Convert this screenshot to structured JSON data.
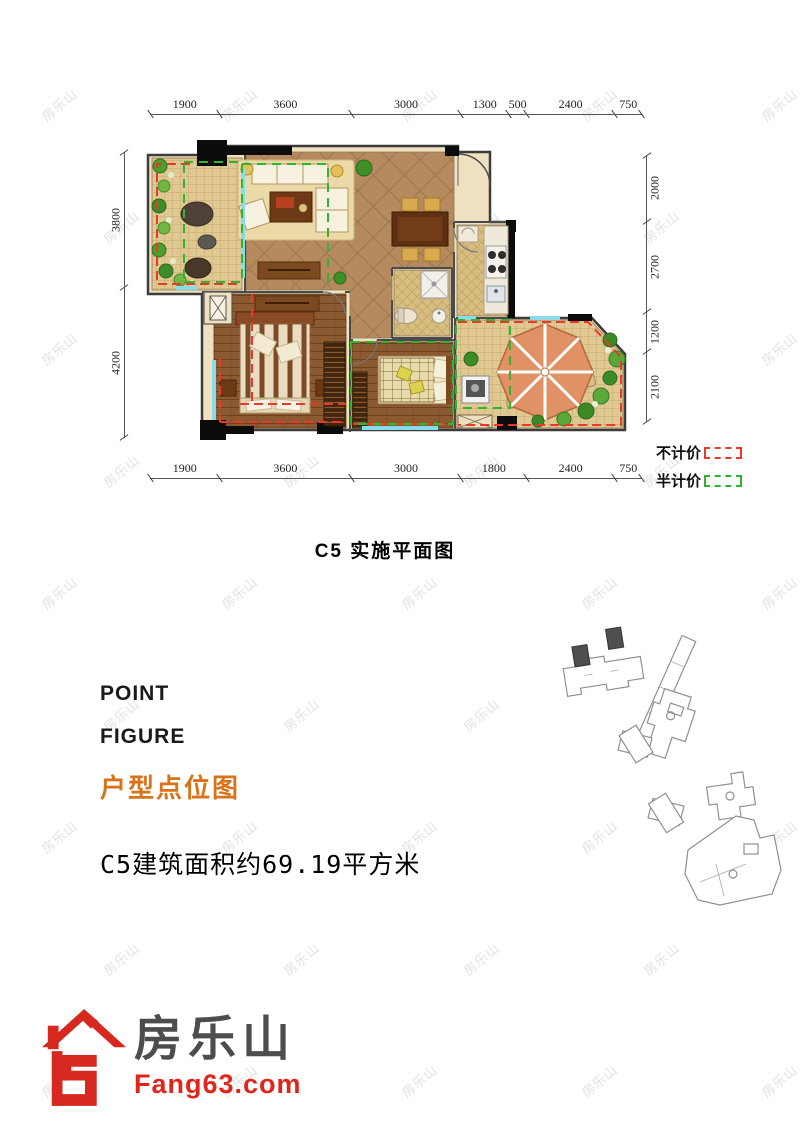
{
  "watermark": {
    "text": "房乐山"
  },
  "floorplan": {
    "title": "C5  实施平面图",
    "dimensions": {
      "top": [
        1900,
        3600,
        3000,
        1300,
        500,
        2400,
        750
      ],
      "bottom": [
        1900,
        3600,
        3000,
        1800,
        2400,
        750
      ],
      "left": [
        3800,
        4200
      ],
      "right": [
        2000,
        2700,
        1200,
        2100
      ]
    },
    "legend": [
      {
        "label": "不计价",
        "color": "#e8392b"
      },
      {
        "label": "半计价",
        "color": "#2fb52f"
      }
    ],
    "colors": {
      "no_price_dash": "#e8392b",
      "half_price_dash": "#2fb52f",
      "window": "#8adbe8",
      "wood_floor": "#8c5a30",
      "tile_floor": "#b48a5e",
      "terrace_tile": "#e0c893"
    }
  },
  "info": {
    "line1": "POINT",
    "line2": "FIGURE",
    "line3": "户型点位图",
    "area_text": "C5建筑面积约69.19平方米",
    "accent_color": "#d9731a"
  },
  "logo": {
    "name": "房乐山",
    "domain": "Fang63.com",
    "red": "#e0251b",
    "gray": "#4d4d4d"
  }
}
